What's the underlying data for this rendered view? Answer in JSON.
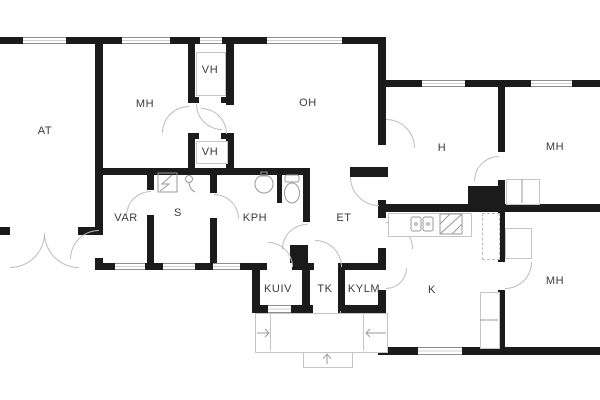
{
  "plan": {
    "type": "floor-plan",
    "rooms": {
      "at": {
        "label": "AT"
      },
      "mh_nw": {
        "label": "MH"
      },
      "vh_top": {
        "label": "VH"
      },
      "vh_bottom": {
        "label": "VH"
      },
      "oh": {
        "label": "OH"
      },
      "var": {
        "label": "VAR"
      },
      "s": {
        "label": "S"
      },
      "kph": {
        "label": "KPH"
      },
      "et": {
        "label": "ET"
      },
      "h": {
        "label": "H"
      },
      "mh_ne": {
        "label": "MH"
      },
      "kuiv": {
        "label": "KUIV"
      },
      "tk": {
        "label": "TK"
      },
      "kylm": {
        "label": "KYLM"
      },
      "k": {
        "label": "K"
      },
      "mh_se": {
        "label": "MH"
      }
    },
    "fixtures": [
      "toilet-icon",
      "washbasin-icon",
      "sauna-stove-icon",
      "shower-icon",
      "kitchen-sink-icon",
      "cooker-icon",
      "chimney-block",
      "wardrobe",
      "porch-steps"
    ],
    "colors": {
      "wall": "#1b1b1b",
      "thin_line": "#c6c6c6",
      "text": "#3a3a3a",
      "background": "#ffffff"
    }
  }
}
